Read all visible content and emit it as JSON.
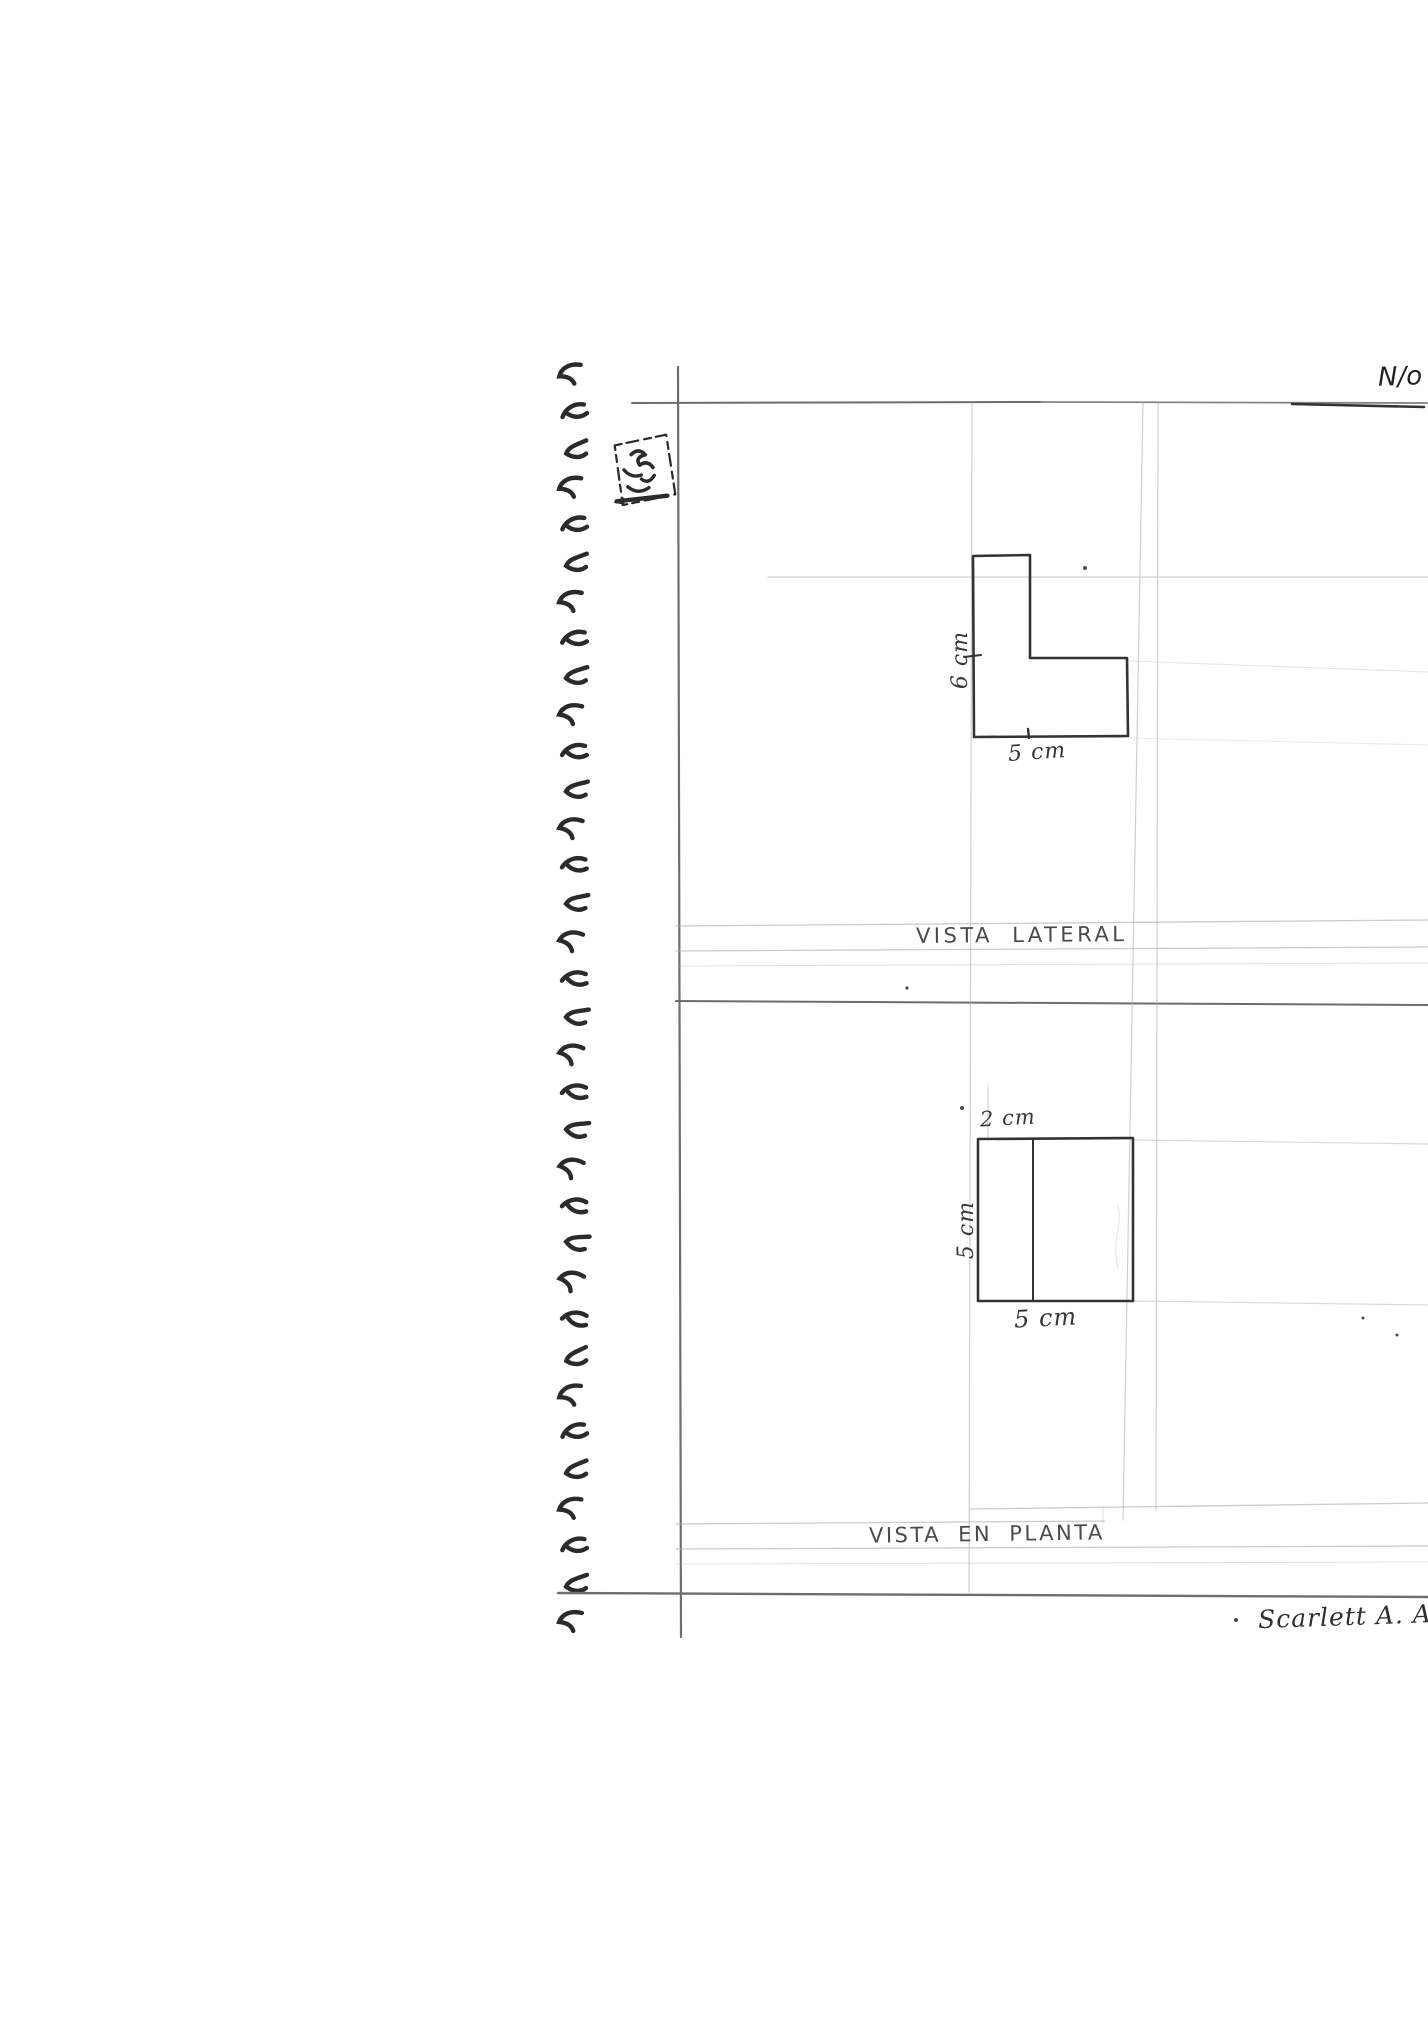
{
  "page": {
    "header": {
      "page_number_label": "N/o"
    },
    "signature": "Scarlett A. Al"
  },
  "views": {
    "lateral": {
      "title": "VISTA LATERAL",
      "dims": {
        "height": "6 cm",
        "width": "5 cm"
      }
    },
    "plan": {
      "title": "VISTA EN PLANTA",
      "dims": {
        "top": "2 cm",
        "side": "5 cm",
        "bottom": "5 cm"
      }
    }
  },
  "notebook": {
    "spiral_ring_count": 34,
    "colors": {
      "ink": "#333333",
      "pencil_rule": "#6e6e6e",
      "guide": "#b8b09f",
      "spiral": "#2b2b2b"
    }
  }
}
